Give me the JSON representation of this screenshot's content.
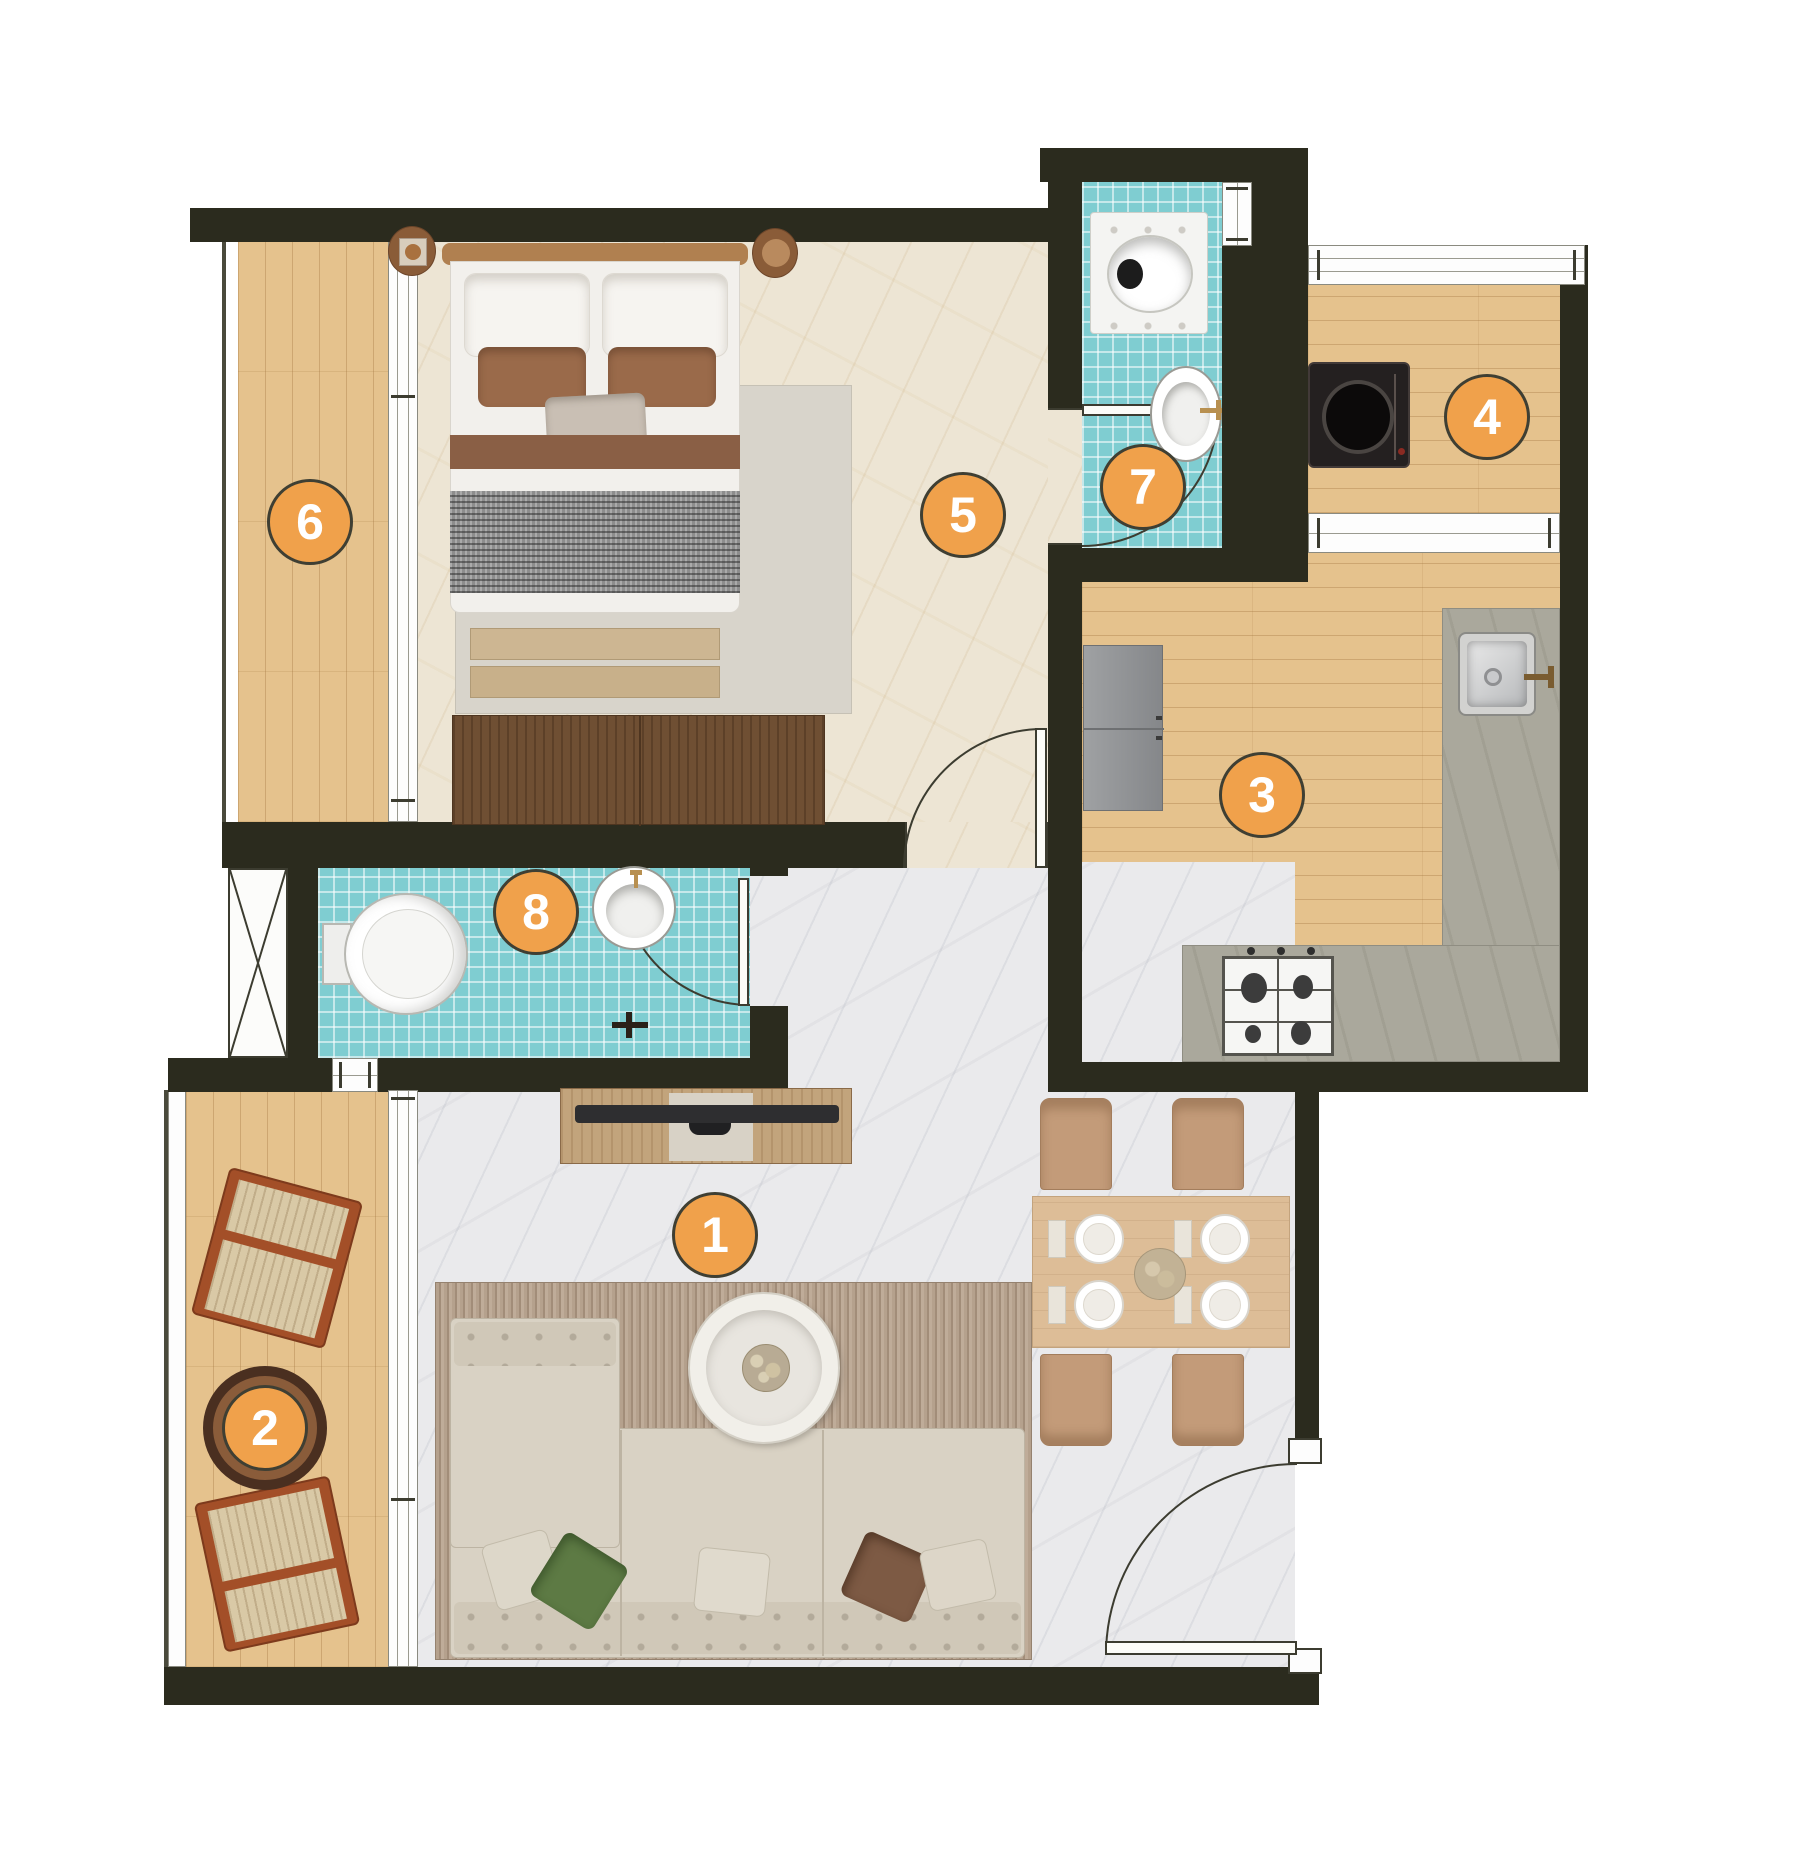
{
  "markers": [
    {
      "label": "1",
      "x": 715,
      "y": 1235
    },
    {
      "label": "2",
      "x": 265,
      "y": 1428
    },
    {
      "label": "3",
      "x": 1262,
      "y": 795
    },
    {
      "label": "4",
      "x": 1487,
      "y": 417
    },
    {
      "label": "5",
      "x": 963,
      "y": 515
    },
    {
      "label": "6",
      "x": 310,
      "y": 522
    },
    {
      "label": "7",
      "x": 1143,
      "y": 487
    },
    {
      "label": "8",
      "x": 536,
      "y": 912
    }
  ],
  "colors": {
    "badge": "#f0a14b",
    "badge-border": "#3f3f33",
    "wall": "#2b2b1e",
    "tile": "#7fcdd1",
    "wood": "#e5c28d",
    "marble-warm": "#ede5d4",
    "marble-cool": "#eaeaec",
    "counter": "#aaa89c"
  }
}
